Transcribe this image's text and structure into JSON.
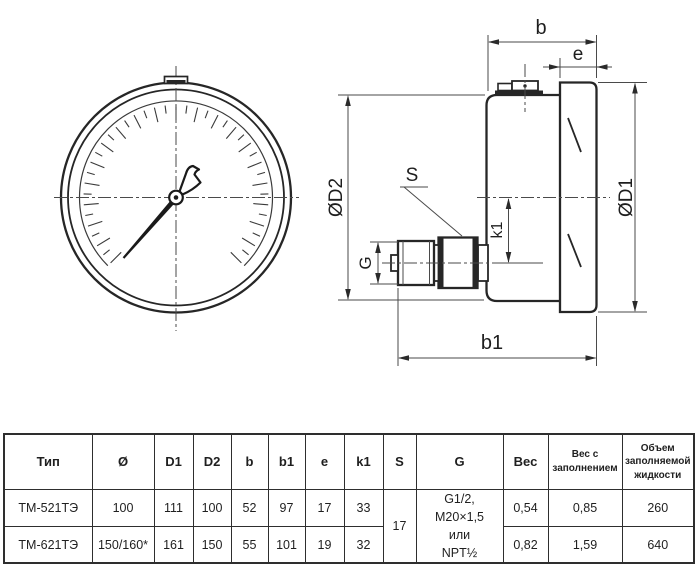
{
  "drawing": {
    "dim_b": "b",
    "dim_e": "e",
    "dim_b1": "b1",
    "dim_k1": "k1",
    "dim_s": "S",
    "dim_g": "G",
    "dim_d1": "ØD1",
    "dim_d2": "ØD2"
  },
  "table": {
    "headers": [
      "Тип",
      "Ø",
      "D1",
      "D2",
      "b",
      "b1",
      "e",
      "k1",
      "S",
      "G",
      "Вес",
      "Вес с заполнением",
      "Объем заполняемой жидкости"
    ],
    "rows": [
      {
        "type": "ТМ-521ТЭ",
        "dia": "100",
        "d1": "111",
        "d2": "100",
        "b": "52",
        "b1": "97",
        "e": "17",
        "k1": "33",
        "weight": "0,54",
        "weight_filled": "0,85",
        "volume": "260"
      },
      {
        "type": "ТМ-621ТЭ",
        "dia": "150/160*",
        "d1": "161",
        "d2": "150",
        "b": "55",
        "b1": "101",
        "e": "19",
        "k1": "32",
        "weight": "0,82",
        "weight_filled": "1,59",
        "volume": "640"
      }
    ],
    "s_merged": "17",
    "g_merged_lines": [
      "G1/2,",
      "M20×1,5",
      "или",
      "NPT½"
    ]
  }
}
